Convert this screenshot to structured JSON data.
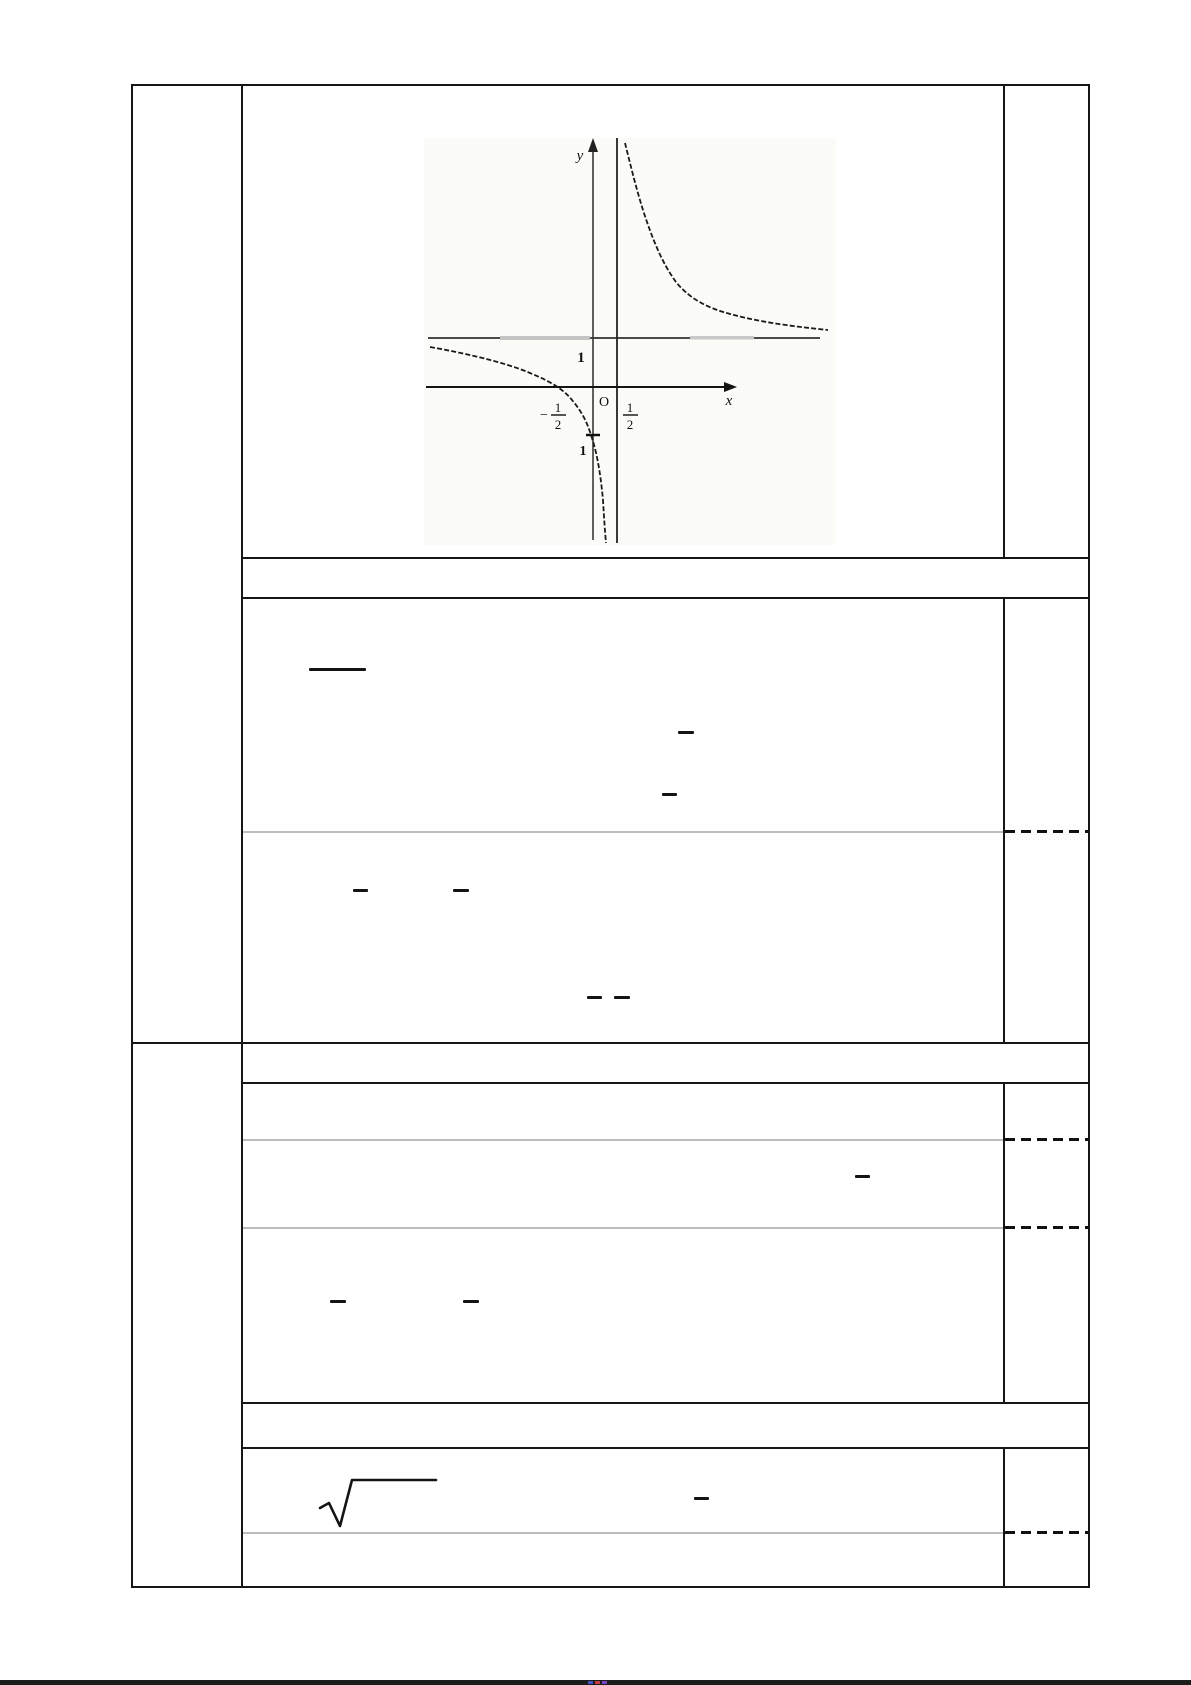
{
  "figure": {
    "labels": {
      "y_axis": "y",
      "x_axis": "x",
      "origin": "O",
      "h_asymptote_value": "1",
      "neg_half_minus": "−",
      "neg_half_num": "1",
      "neg_half_den": "2",
      "pos_half_num": "1",
      "pos_half_den": "2",
      "y_intercept": "1"
    },
    "graph_data": {
      "type": "line",
      "description": "Hyperbola-style rational function with two branches",
      "vertical_asymptote_x": 0.5,
      "horizontal_asymptote_y": 1,
      "x_intercept": -0.5,
      "y_intercept": -1,
      "branches": [
        {
          "name": "left",
          "behavior": "approaches y=1 as x→−∞, falls to −∞ as x→0.5⁻",
          "sample_points": [
            [
              -3,
              0.7
            ],
            [
              -0.5,
              0
            ],
            [
              0,
              -1
            ],
            [
              0.45,
              -30
            ]
          ]
        },
        {
          "name": "right",
          "behavior": "falls from +∞ at x→0.5⁺ toward y=1 as x→+∞",
          "sample_points": [
            [
              0.55,
              30
            ],
            [
              1,
              4
            ],
            [
              3,
              1.6
            ],
            [
              6,
              1.2
            ]
          ]
        }
      ],
      "axis_labels": {
        "x": "x",
        "y": "y"
      },
      "grid": false
    }
  },
  "colors": {
    "table_line": "#161616",
    "gray_divider": "#bdbdbd",
    "dashed_divider": "#111111",
    "footer_strip": "#1b1b1b",
    "speck_blue": "#4054c8",
    "speck_red": "#c84040",
    "speck_purple": "#7a40c8"
  }
}
